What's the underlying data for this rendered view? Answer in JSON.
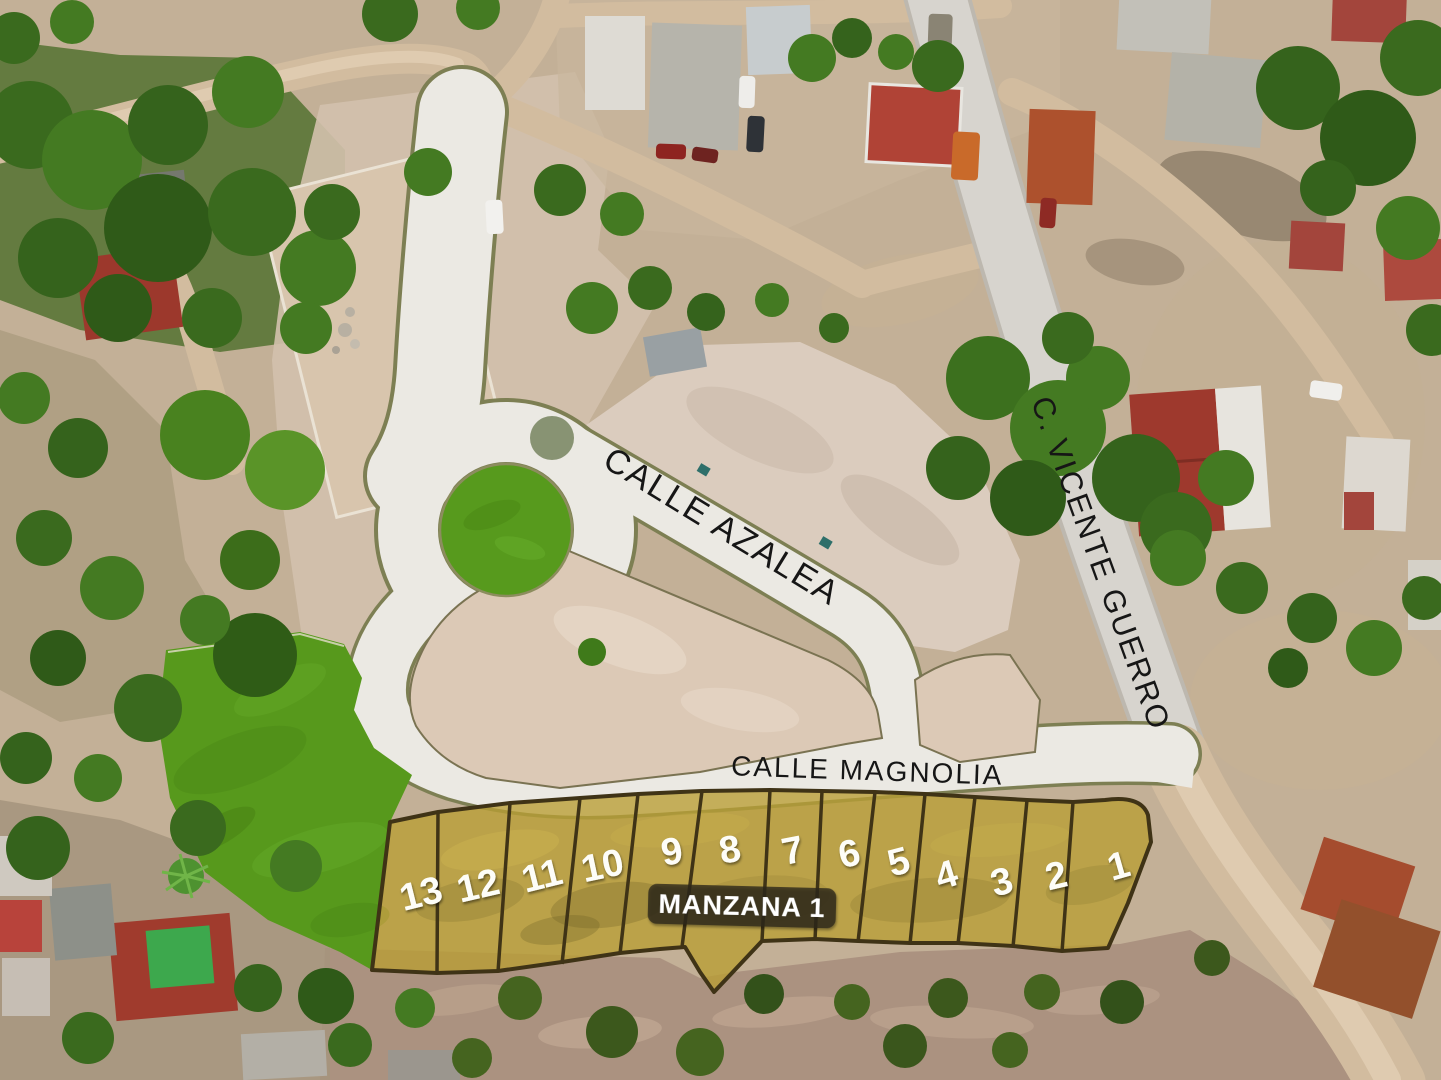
{
  "map": {
    "type": "aerial-lot-map",
    "streets": [
      {
        "id": "calle-azalea",
        "name": "CALLE AZALEA"
      },
      {
        "id": "calle-magnolia",
        "name": "CALLE MAGNOLIA"
      },
      {
        "id": "c-vicente-guerro",
        "name": "C. VICENTE GUERRO"
      }
    ],
    "block": {
      "label": "MANZANA 1",
      "lot_count": 13,
      "lots": [
        {
          "number": "13"
        },
        {
          "number": "12"
        },
        {
          "number": "11"
        },
        {
          "number": "10"
        },
        {
          "number": "9"
        },
        {
          "number": "8"
        },
        {
          "number": "7"
        },
        {
          "number": "6"
        },
        {
          "number": "5"
        },
        {
          "number": "4"
        },
        {
          "number": "3"
        },
        {
          "number": "2"
        },
        {
          "number": "1"
        }
      ]
    },
    "colors": {
      "lot_highlight": "#b89d33",
      "lot_border": "#3f3316",
      "park_green": "#57991c",
      "roundabout_grass": "#579a1d",
      "road_concrete": "#ebe9e3",
      "road_curb": "#7d7f53",
      "paved_road": "#d7d4ce",
      "dirt_road": "#d2bc9f",
      "label_text": "#161616",
      "lot_number_text": "#fdfdf8",
      "badge_bg": "rgba(42,38,28,0.78)",
      "badge_text": "#ffffff"
    }
  }
}
